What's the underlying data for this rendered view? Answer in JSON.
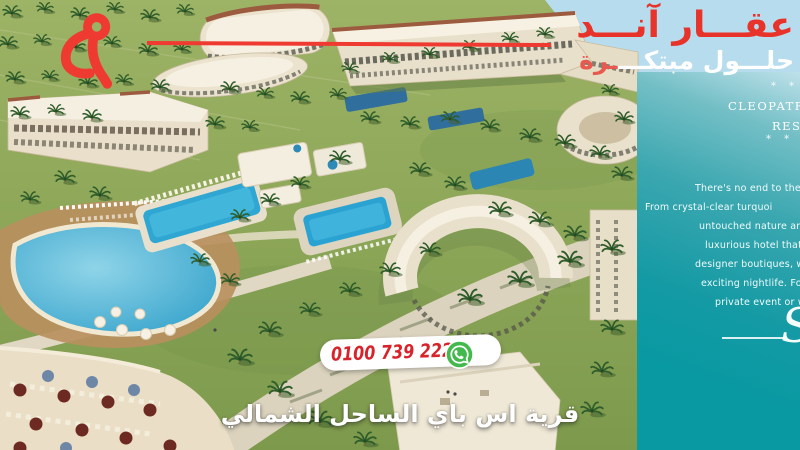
{
  "brand": {
    "name_ar": "عقـــار آنـــد",
    "tagline_ar_main": "حلـــول مبتكـــ",
    "tagline_ar_accent": "ـرة",
    "accent_color": "#e8332a"
  },
  "panel": {
    "stars_top": "* * *",
    "title_line1": "CLEOPATRA",
    "title_line2": "RESORT",
    "stars_bottom": "* * *",
    "paragraph_lines": [
      "There's no end to the fa",
      "From crystal-clear turquoi",
      "untouched nature and",
      "luxurious hotel that o",
      "designer boutiques, wo",
      "exciting nightlife. For a",
      "private event or we"
    ],
    "signature_glyph": "S",
    "bg_top_color": "#bfe1ea",
    "bg_bottom_color": "#0899a2"
  },
  "contact": {
    "phone_number": "0100 739 2222",
    "phone_color": "#d8232a",
    "whatsapp_color": "#43b94d"
  },
  "footer": {
    "project_name_ar": "قرية اس باي الساحل الشمالي"
  },
  "scene": {
    "description": "aerial 3D render of a resort village with pools, palm trees and beach"
  }
}
